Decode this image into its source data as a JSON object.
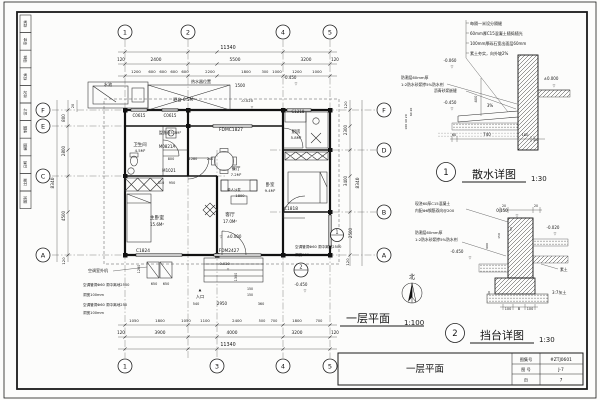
{
  "sheet": {
    "bar_title": "一层平面",
    "title_block": {
      "row1_label": "图集号",
      "row1_value": "#ZTJ0601",
      "row2_label": "图 号",
      "row2_value": "J-7",
      "row3_label": "页",
      "row3_value": "7"
    }
  },
  "strip": {
    "cells": [
      "批准",
      "审定",
      "审核",
      "标准",
      "校对",
      "设计",
      "制图",
      "描图",
      "日期",
      "比例",
      "图别"
    ]
  },
  "plan": {
    "title": "一层平面",
    "scale": "1:100",
    "north_label": "北",
    "callout1": "1",
    "callout2": "2",
    "bubbles": [
      {
        "x": 125,
        "y": 32,
        "s": "1"
      },
      {
        "x": 188,
        "y": 32,
        "s": "2"
      },
      {
        "x": 283,
        "y": 32,
        "s": "4"
      },
      {
        "x": 330,
        "y": 32,
        "s": "5"
      },
      {
        "x": 125,
        "y": 366,
        "s": "1"
      },
      {
        "x": 217,
        "y": 366,
        "s": "3"
      },
      {
        "x": 283,
        "y": 366,
        "s": "4"
      },
      {
        "x": 330,
        "y": 366,
        "s": "5"
      },
      {
        "x": 43,
        "y": 110,
        "s": "F"
      },
      {
        "x": 43,
        "y": 126,
        "s": "E"
      },
      {
        "x": 43,
        "y": 176,
        "s": "C"
      },
      {
        "x": 43,
        "y": 255,
        "s": "A"
      },
      {
        "x": 384,
        "y": 110,
        "s": "F"
      },
      {
        "x": 384,
        "y": 150,
        "s": "D"
      },
      {
        "x": 384,
        "y": 212,
        "s": "B"
      },
      {
        "x": 384,
        "y": 255,
        "s": "A"
      }
    ],
    "texts": [
      {
        "x": 228,
        "y": 49,
        "s": "11340",
        "z": 4.8,
        "n": "dim-total-top"
      },
      {
        "x": 121,
        "y": 61,
        "s": "120",
        "z": 4
      },
      {
        "x": 156,
        "y": 61,
        "s": "2400",
        "z": 4.3
      },
      {
        "x": 235,
        "y": 61,
        "s": "5500",
        "z": 4.3
      },
      {
        "x": 306,
        "y": 61,
        "s": "3200",
        "z": 4.3
      },
      {
        "x": 335,
        "y": 61,
        "s": "120",
        "z": 4
      },
      {
        "x": 136,
        "y": 73,
        "s": "1200",
        "z": 3.8
      },
      {
        "x": 152,
        "y": 73,
        "s": "600",
        "z": 3.8
      },
      {
        "x": 163,
        "y": 73,
        "s": "600",
        "z": 3.8
      },
      {
        "x": 174,
        "y": 73,
        "s": "600",
        "z": 3.8
      },
      {
        "x": 185,
        "y": 73,
        "s": "600",
        "z": 3.8
      },
      {
        "x": 210,
        "y": 73,
        "s": "2200",
        "z": 3.8
      },
      {
        "x": 246,
        "y": 73,
        "s": "1800",
        "z": 3.8
      },
      {
        "x": 265,
        "y": 73,
        "s": "300",
        "z": 3.5
      },
      {
        "x": 277,
        "y": 73,
        "s": "1000",
        "z": 3.8
      },
      {
        "x": 297,
        "y": 73,
        "s": "1200",
        "z": 3.8
      },
      {
        "x": 317,
        "y": 73,
        "s": "1000",
        "z": 3.8
      },
      {
        "x": 240,
        "y": 87,
        "s": "1500",
        "z": 4
      },
      {
        "x": 290,
        "y": 79,
        "s": "-0.450",
        "z": 4
      },
      {
        "x": 296,
        "y": 85,
        "s": "▽",
        "z": 3.5
      },
      {
        "x": 247,
        "y": 102,
        "s": "-0.020",
        "z": 3.8
      },
      {
        "x": 252,
        "y": 108,
        "s": "▽",
        "z": 3.2
      },
      {
        "x": 134,
        "y": 322,
        "s": "1050",
        "z": 3.8
      },
      {
        "x": 160,
        "y": 322,
        "s": "1800",
        "z": 3.8
      },
      {
        "x": 186,
        "y": 322,
        "s": "1050",
        "z": 3.8
      },
      {
        "x": 205,
        "y": 322,
        "s": "1100",
        "z": 3.8
      },
      {
        "x": 237,
        "y": 322,
        "s": "2400",
        "z": 3.8
      },
      {
        "x": 262,
        "y": 322,
        "s": "500",
        "z": 3.5
      },
      {
        "x": 274,
        "y": 322,
        "s": "700",
        "z": 3.5
      },
      {
        "x": 297,
        "y": 322,
        "s": "1800",
        "z": 3.8
      },
      {
        "x": 319,
        "y": 322,
        "s": "700",
        "z": 3.5
      },
      {
        "x": 121,
        "y": 334,
        "s": "120",
        "z": 4
      },
      {
        "x": 160,
        "y": 334,
        "s": "3900",
        "z": 4.3
      },
      {
        "x": 232,
        "y": 334,
        "s": "4000",
        "z": 4.3
      },
      {
        "x": 297,
        "y": 334,
        "s": "3200",
        "z": 4.3
      },
      {
        "x": 335,
        "y": 334,
        "s": "120",
        "z": 4
      },
      {
        "x": 228,
        "y": 346,
        "s": "11340",
        "z": 4.8,
        "n": "dim-total-bottom"
      },
      {
        "x": 74,
        "y": 106,
        "s": "20",
        "z": 3.5,
        "r": -90
      },
      {
        "x": 65,
        "y": 118,
        "s": "800",
        "z": 4,
        "r": -90
      },
      {
        "x": 65,
        "y": 151,
        "s": "2800",
        "z": 4,
        "r": -90
      },
      {
        "x": 65,
        "y": 216,
        "s": "4500",
        "z": 4,
        "r": -90
      },
      {
        "x": 65,
        "y": 261,
        "s": "120",
        "z": 3.8,
        "r": -90
      },
      {
        "x": 54,
        "y": 183,
        "s": "8340",
        "z": 4.3,
        "r": -90
      },
      {
        "x": 347,
        "y": 105,
        "s": "120",
        "z": 3.8,
        "r": -90
      },
      {
        "x": 347,
        "y": 130,
        "s": "2300",
        "z": 4,
        "r": -90
      },
      {
        "x": 347,
        "y": 181,
        "s": "3400",
        "z": 4,
        "r": -90
      },
      {
        "x": 352,
        "y": 233,
        "s": "2500",
        "z": 4,
        "r": -90
      },
      {
        "x": 349,
        "y": 262,
        "s": "120",
        "z": 3.8,
        "r": -90
      },
      {
        "x": 359,
        "y": 183,
        "s": "8340",
        "z": 4.3,
        "r": -90
      },
      {
        "x": 108,
        "y": 86,
        "s": "水池",
        "z": 4.2,
        "n": "room-label"
      },
      {
        "x": 201,
        "y": 83,
        "s": "热水器位置",
        "z": 4,
        "n": "note"
      },
      {
        "x": 184,
        "y": 101,
        "s": "晒台 6.5M²",
        "z": 4.2,
        "n": "room-label"
      },
      {
        "x": 139,
        "y": 117,
        "s": "C0615",
        "z": 4,
        "n": "window-tag"
      },
      {
        "x": 170,
        "y": 117,
        "s": "C0615",
        "z": 4,
        "n": "window-tag"
      },
      {
        "x": 140,
        "y": 146,
        "s": "卫生间",
        "z": 4.4,
        "n": "room-label"
      },
      {
        "x": 140,
        "y": 152,
        "s": "4.5M²",
        "z": 3.8
      },
      {
        "x": 170,
        "y": 134,
        "s": "盥洗间3.3M²",
        "z": 3.8,
        "n": "room-label"
      },
      {
        "x": 167,
        "y": 148,
        "s": "M0821A",
        "z": 4,
        "n": "door-tag"
      },
      {
        "x": 171,
        "y": 160,
        "s": "800",
        "z": 3.4
      },
      {
        "x": 193,
        "y": 160,
        "s": "1280",
        "z": 3.4
      },
      {
        "x": 210,
        "y": 160,
        "s": "240",
        "z": 3.4
      },
      {
        "x": 161,
        "y": 184,
        "s": "310",
        "z": 3.4
      },
      {
        "x": 172,
        "y": 184,
        "s": "950",
        "z": 3.4
      },
      {
        "x": 169,
        "y": 172,
        "s": "M1021",
        "z": 4,
        "n": "door-tag"
      },
      {
        "x": 231,
        "y": 131,
        "s": "FDMC1827",
        "z": 4.4,
        "n": "door-tag"
      },
      {
        "x": 236,
        "y": 170,
        "s": "餐厅",
        "z": 4.4,
        "n": "room-label"
      },
      {
        "x": 236,
        "y": 176,
        "s": "7.2M²",
        "z": 3.8
      },
      {
        "x": 296,
        "y": 133,
        "s": "厨房",
        "z": 4.4,
        "n": "room-label"
      },
      {
        "x": 296,
        "y": 139,
        "s": "5.8M²",
        "z": 3.8
      },
      {
        "x": 298,
        "y": 113,
        "s": "C1218",
        "z": 4,
        "n": "window-tag"
      },
      {
        "x": 234,
        "y": 191,
        "s": "单人沙发",
        "z": 3.4,
        "n": "note"
      },
      {
        "x": 240,
        "y": 197,
        "s": "1800",
        "z": 3.6
      },
      {
        "x": 230,
        "y": 216,
        "s": "客厅",
        "z": 4.8,
        "n": "room-label"
      },
      {
        "x": 230,
        "y": 223,
        "s": "17.0M²",
        "z": 4
      },
      {
        "x": 221,
        "y": 238,
        "s": "▽",
        "z": 3.5
      },
      {
        "x": 234,
        "y": 238,
        "s": "±0.000",
        "z": 4,
        "n": "level-mark"
      },
      {
        "x": 157,
        "y": 219,
        "s": "主卧室",
        "z": 4.8,
        "n": "room-label"
      },
      {
        "x": 157,
        "y": 226,
        "s": "15.6M²",
        "z": 4
      },
      {
        "x": 270,
        "y": 186,
        "s": "卧室",
        "z": 4.4,
        "n": "room-label"
      },
      {
        "x": 270,
        "y": 192,
        "s": "9.4M²",
        "z": 3.8
      },
      {
        "x": 143,
        "y": 252,
        "s": "C1824",
        "z": 4.3,
        "n": "window-tag"
      },
      {
        "x": 229,
        "y": 252,
        "s": "FDM2427",
        "z": 4.3,
        "n": "door-tag"
      },
      {
        "x": 291,
        "y": 210,
        "s": "C1818",
        "z": 4.3,
        "n": "window-tag"
      },
      {
        "x": 224,
        "y": 265,
        "s": "-0.020",
        "z": 3.6,
        "n": "level-mark"
      },
      {
        "x": 228,
        "y": 270,
        "s": "▽",
        "z": 3
      },
      {
        "x": 301,
        "y": 286,
        "s": "-0.450",
        "z": 4,
        "n": "level-mark"
      },
      {
        "x": 305,
        "y": 292,
        "s": "▽",
        "z": 3.5
      },
      {
        "x": 200,
        "y": 291,
        "s": "▲",
        "z": 3.5,
        "n": "entry-arrow"
      },
      {
        "x": 200,
        "y": 298,
        "s": "入口",
        "z": 4.2,
        "n": "entry-label"
      },
      {
        "x": 196,
        "y": 305,
        "s": "540",
        "z": 3.4
      },
      {
        "x": 222,
        "y": 305,
        "s": "2950",
        "z": 4
      },
      {
        "x": 261,
        "y": 305,
        "s": "360",
        "z": 3.4
      },
      {
        "x": 237,
        "y": 277,
        "s": "1300",
        "z": 3.4,
        "r": -90
      },
      {
        "x": 250,
        "y": 290,
        "s": "150",
        "z": 3.2
      },
      {
        "x": 250,
        "y": 296,
        "s": "150",
        "z": 3.2
      },
      {
        "x": 140,
        "y": 269,
        "s": "1280",
        "z": 3.4,
        "r": -90
      },
      {
        "x": 154,
        "y": 285,
        "s": "650",
        "z": 3.4
      },
      {
        "x": 166,
        "y": 285,
        "s": "650",
        "z": 3.4
      },
      {
        "x": 88,
        "y": 272,
        "s": "空调室外机",
        "z": 4,
        "a": "start",
        "n": "note"
      },
      {
        "x": 83,
        "y": 286,
        "s": "空调管洞Φ60 洞中离地2500",
        "z": 3.6,
        "a": "start",
        "n": "note"
      },
      {
        "x": 83,
        "y": 296,
        "s": "洞宽100mm",
        "z": 3.6,
        "a": "start",
        "n": "note"
      },
      {
        "x": 83,
        "y": 306,
        "s": "空调管洞Φ60 洞中离地250",
        "z": 3.6,
        "a": "start",
        "n": "note"
      },
      {
        "x": 83,
        "y": 314,
        "s": "洞宽100mm",
        "z": 3.6,
        "a": "start",
        "n": "note"
      },
      {
        "x": 295,
        "y": 248,
        "s": "空调管洞Φ60 洞中离地2500",
        "z": 3.6,
        "a": "start",
        "n": "note"
      },
      {
        "x": 295,
        "y": 256,
        "s": "洞宽100mm",
        "z": 3.6,
        "a": "start",
        "n": "note"
      }
    ]
  },
  "detail1": {
    "num": "1",
    "title": "散水详图",
    "scale": "1:30",
    "texts": [
      {
        "x": 470,
        "y": 25,
        "s": "每隔一米设分隔缝",
        "a": "start",
        "z": 4,
        "n": "note"
      },
      {
        "x": 470,
        "y": 35,
        "s": "60mm厚C15混凝土随捣随光",
        "a": "start",
        "z": 4,
        "n": "note"
      },
      {
        "x": 470,
        "y": 45,
        "s": "100mm厚砾石宽出面层60mm",
        "a": "start",
        "z": 4,
        "n": "note"
      },
      {
        "x": 470,
        "y": 55,
        "s": "素土夯实，向外坡2%",
        "a": "start",
        "z": 4,
        "n": "note"
      },
      {
        "x": 450,
        "y": 62,
        "s": "-0.060",
        "z": 4,
        "n": "level-mark"
      },
      {
        "x": 452,
        "y": 68,
        "s": "▽",
        "z": 3.5
      },
      {
        "x": 401,
        "y": 79,
        "s": "防潮层60mm厚",
        "a": "start",
        "z": 3.8,
        "n": "note"
      },
      {
        "x": 401,
        "y": 86,
        "s": "1:2防水砂浆掺5%防水剂",
        "a": "start",
        "z": 3.8,
        "n": "note"
      },
      {
        "x": 434,
        "y": 92,
        "s": "沥青砂浆嵌缝",
        "a": "start",
        "z": 3.8,
        "n": "note"
      },
      {
        "x": 551,
        "y": 80,
        "s": "±0.000",
        "z": 4,
        "n": "level-mark"
      },
      {
        "x": 554,
        "y": 87,
        "s": "▽",
        "z": 3.5
      },
      {
        "x": 490,
        "y": 107,
        "s": "3%",
        "z": 4
      },
      {
        "x": 477,
        "y": 99,
        "s": "400",
        "z": 3.6,
        "r": -90
      },
      {
        "x": 450,
        "y": 104,
        "s": "-0.450",
        "z": 4,
        "n": "level-mark"
      },
      {
        "x": 452,
        "y": 110,
        "s": "▽",
        "z": 3.5
      },
      {
        "x": 454,
        "y": 136,
        "s": "60",
        "z": 3.6
      },
      {
        "x": 487,
        "y": 136,
        "s": "740",
        "z": 4
      },
      {
        "x": 525,
        "y": 136,
        "s": "180",
        "z": 3.6
      },
      {
        "x": 536,
        "y": 141,
        "s": "20",
        "z": 3.2
      },
      {
        "x": 412,
        "y": 112,
        "s": "60 20",
        "z": 3,
        "r": -90
      },
      {
        "x": 407,
        "y": 122,
        "s": "100 40 20",
        "z": 3,
        "r": -90
      }
    ]
  },
  "detail2": {
    "num": "2",
    "title": "挡台详图",
    "scale": "1:30",
    "texts": [
      {
        "x": 415,
        "y": 205,
        "s": "现浇60厚C15混凝土",
        "a": "start",
        "z": 3.8,
        "n": "note"
      },
      {
        "x": 415,
        "y": 212,
        "s": "内配Φ6钢筋双向@200",
        "a": "start",
        "z": 3.8,
        "n": "note"
      },
      {
        "x": 502,
        "y": 212,
        "s": "0.150",
        "z": 4,
        "n": "level-mark"
      },
      {
        "x": 517,
        "y": 217,
        "s": "▽",
        "z": 3.5
      },
      {
        "x": 504,
        "y": 207,
        "s": "20",
        "z": 3.2
      },
      {
        "x": 536,
        "y": 207,
        "s": "20",
        "z": 3.2
      },
      {
        "x": 553,
        "y": 229,
        "s": "-0.020",
        "z": 4,
        "n": "level-mark"
      },
      {
        "x": 555,
        "y": 235,
        "s": "▽",
        "z": 3.5
      },
      {
        "x": 415,
        "y": 234,
        "s": "防潮层60mm厚",
        "a": "start",
        "z": 3.8,
        "n": "note"
      },
      {
        "x": 415,
        "y": 241,
        "s": "1:2防水砂浆掺5%防水剂",
        "a": "start",
        "z": 3.8,
        "n": "note"
      },
      {
        "x": 457,
        "y": 253,
        "s": "-0.450",
        "z": 4,
        "n": "level-mark"
      },
      {
        "x": 470,
        "y": 259,
        "s": "▽",
        "z": 3.5
      },
      {
        "x": 512,
        "y": 229,
        "s": "50",
        "z": 3,
        "r": -90
      },
      {
        "x": 500,
        "y": 236,
        "s": "150",
        "z": 3,
        "r": -90
      },
      {
        "x": 488,
        "y": 246,
        "s": "600",
        "z": 3,
        "r": -90
      },
      {
        "x": 560,
        "y": 271,
        "s": "素土",
        "z": 3.8,
        "a": "start",
        "n": "note"
      },
      {
        "x": 552,
        "y": 294,
        "s": "3:7灰土",
        "z": 4,
        "a": "start",
        "n": "note"
      },
      {
        "x": 490,
        "y": 293,
        "s": "50",
        "z": 3,
        "r": -90
      },
      {
        "x": 508,
        "y": 310,
        "s": "100",
        "z": 3.4
      },
      {
        "x": 519,
        "y": 310,
        "s": "B",
        "z": 3.6
      },
      {
        "x": 530,
        "y": 310,
        "s": "100",
        "z": 3.4
      }
    ]
  }
}
